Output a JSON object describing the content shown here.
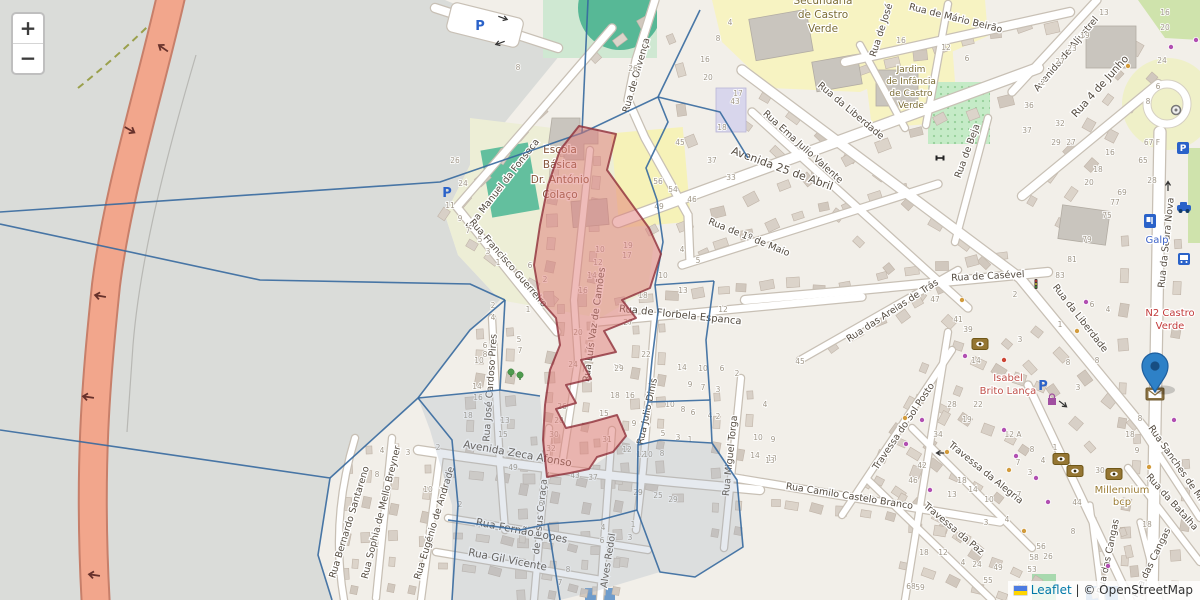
{
  "map": {
    "controls": {
      "zoom_in": "+",
      "zoom_out": "−"
    },
    "attribution": {
      "leaflet": "Leaflet",
      "separator": " | © ",
      "osm": "OpenStreetMap",
      "flag": "ukraine-flag"
    },
    "accent_colors": {
      "marker_blue": "#2E81C7",
      "overlay_red": "#E07A76",
      "overlay_red_border": "#8F2F3A",
      "boundary_blue": "#36699E",
      "trunk_road": "#F2A68C",
      "link_blue": "#0078A8"
    },
    "street_labels": [
      {
        "text": "Rua Manuel da Fonseca",
        "x": 505,
        "y": 186,
        "r": -52
      },
      {
        "text": "Rua Francisco Guerreiro",
        "x": 506,
        "y": 265,
        "r": 49
      },
      {
        "text": "Rua de Olivença",
        "x": 639,
        "y": 76,
        "r": -74
      },
      {
        "text": "Avenida 25 de Abril",
        "x": 781,
        "y": 172,
        "r": 20,
        "s": 11
      },
      {
        "text": "Rua da Liberdade",
        "x": 849,
        "y": 113,
        "r": 40
      },
      {
        "text": "Rua Ema Julio Valente",
        "x": 801,
        "y": 149,
        "r": 42
      },
      {
        "text": "Rua de Mário Beirão",
        "x": 955,
        "y": 21,
        "r": 14
      },
      {
        "text": "Rua de José",
        "x": 884,
        "y": 31,
        "r": -72
      },
      {
        "text": "Rua de Beja",
        "x": 970,
        "y": 152,
        "r": -70
      },
      {
        "text": "Avenida de Aljustrel",
        "x": 1038,
        "y": 92,
        "r": -50,
        "a": "start"
      },
      {
        "text": "Rua 4 de Junho",
        "x": 1076,
        "y": 118,
        "r": -48,
        "a": "start",
        "s": 10.5
      },
      {
        "text": "Rua da Seara Nova",
        "x": 1169,
        "y": 243,
        "r": -84
      },
      {
        "text": "Rua de Casével",
        "x": 988,
        "y": 279,
        "r": -3
      },
      {
        "text": "Rua da Liberdade",
        "x": 1078,
        "y": 320,
        "r": 52
      },
      {
        "text": "Rua de Florbela Espanca",
        "x": 680,
        "y": 318,
        "r": 6,
        "s": 10
      },
      {
        "text": "Rua de 1º de Maio",
        "x": 748,
        "y": 240,
        "r": 22
      },
      {
        "text": "Rua Luís Vaz de Camões",
        "x": 597,
        "y": 325,
        "r": -82
      },
      {
        "text": "Rua José Cardoso Pires",
        "x": 493,
        "y": 388,
        "r": -86
      },
      {
        "text": "Rua Julio Dinis",
        "x": 650,
        "y": 412,
        "r": -78
      },
      {
        "text": "Rua Miguel Torga",
        "x": 733,
        "y": 456,
        "r": -84
      },
      {
        "text": "Avenida Zeca Afonso",
        "x": 517,
        "y": 457,
        "r": 10,
        "s": 10.5
      },
      {
        "text": "Rua Fernão Lopes",
        "x": 521,
        "y": 534,
        "r": 11,
        "s": 10.5
      },
      {
        "text": "Rua Gil Vicente",
        "x": 507,
        "y": 563,
        "r": 11,
        "s": 10.5
      },
      {
        "text": "Rua Bernardo Santareno",
        "x": 352,
        "y": 523,
        "r": -73
      },
      {
        "text": "Rua Sophia de Mello Breyner",
        "x": 384,
        "y": 513,
        "r": -76
      },
      {
        "text": "Rua Eugénio de Andrade",
        "x": 437,
        "y": 524,
        "r": -73
      },
      {
        "text": "de Jesus Caraça",
        "x": 543,
        "y": 517,
        "r": -84
      },
      {
        "text": "Alves Redol",
        "x": 611,
        "y": 561,
        "r": -81
      },
      {
        "text": "Rua Camilo Castelo Branco",
        "x": 849,
        "y": 499,
        "r": 9
      },
      {
        "text": "Rua das Areias de Trás",
        "x": 894,
        "y": 313,
        "r": -33
      },
      {
        "text": "Travessa do Sol Posto",
        "x": 906,
        "y": 428,
        "r": -56
      },
      {
        "text": "Travessa da Alegria",
        "x": 984,
        "y": 475,
        "r": 39
      },
      {
        "text": "Travessa da Paz",
        "x": 952,
        "y": 531,
        "r": 40
      },
      {
        "text": "Rua Sanches de Miranda",
        "x": 1148,
        "y": 428,
        "r": 55,
        "a": "start"
      },
      {
        "text": "Rua da Batalha",
        "x": 1170,
        "y": 504,
        "r": 48
      },
      {
        "text": "Rua das Cangas",
        "x": 1111,
        "y": 557,
        "r": -78
      },
      {
        "text": "Rua das Cangas",
        "x": 1154,
        "y": 564,
        "r": -64
      }
    ],
    "poi_labels": [
      {
        "name": "school-basica-label",
        "lines": [
          "Escola",
          "Básica",
          "Dr. António",
          "Colaço"
        ],
        "x": 560,
        "y": 153,
        "lh": 15,
        "c": "#85553a",
        "s": 10.5
      },
      {
        "name": "school-secundaria-label",
        "lines": [
          "Secundária",
          "de Castro",
          "Verde"
        ],
        "x": 823,
        "y": 4,
        "lh": 14,
        "c": "#7b6c34",
        "s": 10.5
      },
      {
        "name": "kindergarten-label",
        "lines": [
          "Jardim",
          "de Infância",
          "de Castro",
          "Verde"
        ],
        "x": 911,
        "y": 72,
        "lh": 12,
        "c": "#7b6c34",
        "s": 9
      },
      {
        "name": "shop-isabel-label",
        "lines": [
          "Isabel",
          "Brito Lança"
        ],
        "x": 1008,
        "y": 381,
        "lh": 13,
        "c": "#c0504a",
        "s": 10
      },
      {
        "name": "n2-junction-label",
        "lines": [
          "N2 Castro",
          "Verde"
        ],
        "x": 1170,
        "y": 316,
        "lh": 13,
        "c": "#c23b3b",
        "s": 10
      },
      {
        "name": "galp-fuel-label",
        "lines": [
          "Galp"
        ],
        "x": 1157,
        "y": 243,
        "lh": 12,
        "c": "#3f64c8",
        "s": 10
      },
      {
        "name": "millennium-bank-label",
        "lines": [
          "Millennium",
          "bcp"
        ],
        "x": 1122,
        "y": 493,
        "lh": 12,
        "c": "#9b7c34",
        "s": 10
      }
    ],
    "icons": [
      {
        "name": "parking-icon",
        "x": 480,
        "y": 26
      },
      {
        "name": "parking-icon",
        "x": 447,
        "y": 193
      },
      {
        "name": "parking-icon",
        "x": 1043,
        "y": 386
      },
      {
        "name": "parking-box-icon",
        "x": 1183,
        "y": 148
      },
      {
        "name": "fuel-icon",
        "x": 1150,
        "y": 221
      },
      {
        "name": "bus-icon",
        "x": 1184,
        "y": 259
      },
      {
        "name": "car-icon",
        "x": 1184,
        "y": 208
      },
      {
        "name": "bank-icon",
        "x": 980,
        "y": 344
      },
      {
        "name": "bank-icon",
        "x": 1061,
        "y": 459
      },
      {
        "name": "bank-icon",
        "x": 1075,
        "y": 471
      },
      {
        "name": "bank-icon",
        "x": 1114,
        "y": 474
      },
      {
        "name": "post-envelope-icon",
        "x": 1155,
        "y": 394
      },
      {
        "name": "shopping-bag-icon",
        "x": 1052,
        "y": 400
      },
      {
        "name": "tree-icon",
        "x": 511,
        "y": 373
      },
      {
        "name": "tree-icon",
        "x": 520,
        "y": 376
      },
      {
        "name": "fitness-icon",
        "x": 940,
        "y": 158
      },
      {
        "name": "roundabout-monument-icon",
        "x": 1176,
        "y": 110
      },
      {
        "name": "traffic-signals-icon",
        "x": 1036,
        "y": 284
      }
    ],
    "poi_dots": {
      "purple": [
        [
          965,
          356
        ],
        [
          1004,
          430
        ],
        [
          1016,
          456
        ],
        [
          1036,
          478
        ],
        [
          1048,
          502
        ],
        [
          922,
          420
        ],
        [
          906,
          444
        ],
        [
          1086,
          302
        ],
        [
          1171,
          47
        ],
        [
          1196,
          40
        ],
        [
          1108,
          566
        ],
        [
          930,
          490
        ],
        [
          1174,
          420
        ]
      ],
      "orange": [
        [
          947,
          452
        ],
        [
          1009,
          470
        ],
        [
          1077,
          331
        ],
        [
          1149,
          467
        ],
        [
          1024,
          531
        ],
        [
          962,
          300
        ],
        [
          1128,
          66
        ],
        [
          905,
          418
        ]
      ],
      "red": [
        [
          1004,
          360
        ]
      ]
    },
    "house_numbers": [
      [
        "26",
        455,
        163
      ],
      [
        "24",
        463,
        186
      ],
      [
        "8",
        518,
        70
      ],
      [
        "11",
        450,
        208
      ],
      [
        "9",
        460,
        221
      ],
      [
        "7",
        468,
        233
      ],
      [
        "5",
        480,
        242
      ],
      [
        "3",
        488,
        254
      ],
      [
        "1",
        498,
        265
      ],
      [
        "6",
        530,
        268
      ],
      [
        "2",
        545,
        282
      ],
      [
        "2",
        493,
        308
      ],
      [
        "4",
        493,
        320
      ],
      [
        "1",
        528,
        312
      ],
      [
        "5",
        519,
        342
      ],
      [
        "7",
        520,
        353
      ],
      [
        "6",
        485,
        348
      ],
      [
        "8",
        485,
        357
      ],
      [
        "10",
        479,
        363
      ],
      [
        "14",
        477,
        389
      ],
      [
        "16",
        478,
        400
      ],
      [
        "18",
        468,
        418
      ],
      [
        "10",
        600,
        252
      ],
      [
        "12",
        598,
        265
      ],
      [
        "14",
        592,
        278
      ],
      [
        "16",
        583,
        293
      ],
      [
        "19",
        628,
        248
      ],
      [
        "17",
        627,
        258
      ],
      [
        "18",
        615,
        398
      ],
      [
        "15",
        604,
        416
      ],
      [
        "13",
        505,
        423
      ],
      [
        "15",
        503,
        437
      ],
      [
        "20",
        578,
        335
      ],
      [
        "24",
        573,
        367
      ],
      [
        "19",
        618,
        370
      ],
      [
        "27",
        628,
        325
      ],
      [
        "22",
        646,
        357
      ],
      [
        "29",
        619,
        371
      ],
      [
        "26",
        562,
        409
      ],
      [
        "28",
        559,
        423
      ],
      [
        "30",
        554,
        437
      ],
      [
        "32",
        551,
        451
      ],
      [
        "31",
        607,
        442
      ],
      [
        "9",
        634,
        426
      ],
      [
        "49",
        513,
        470
      ],
      [
        "16",
        630,
        398
      ],
      [
        "18",
        643,
        298
      ],
      [
        "4",
        682,
        252
      ],
      [
        "5",
        698,
        263
      ],
      [
        "10",
        663,
        278
      ],
      [
        "13",
        683,
        293
      ],
      [
        "12",
        723,
        312
      ],
      [
        "14",
        682,
        370
      ],
      [
        "10",
        703,
        371
      ],
      [
        "6",
        722,
        371
      ],
      [
        "2",
        737,
        376
      ],
      [
        "9",
        690,
        387
      ],
      [
        "7",
        703,
        390
      ],
      [
        "3",
        718,
        392
      ],
      [
        "10",
        670,
        407
      ],
      [
        "8",
        683,
        412
      ],
      [
        "6",
        693,
        415
      ],
      [
        "4",
        710,
        418
      ],
      [
        "2",
        718,
        419
      ],
      [
        "5",
        663,
        436
      ],
      [
        "3",
        678,
        440
      ],
      [
        "1",
        690,
        442
      ],
      [
        "12",
        641,
        457
      ],
      [
        "4",
        548,
        478
      ],
      [
        "6",
        541,
        506
      ],
      [
        "43",
        575,
        478
      ],
      [
        "37",
        593,
        480
      ],
      [
        "12",
        627,
        452
      ],
      [
        "10",
        648,
        457
      ],
      [
        "8",
        662,
        456
      ],
      [
        "29",
        638,
        495
      ],
      [
        "25",
        658,
        498
      ],
      [
        "29",
        673,
        502
      ],
      [
        "1",
        633,
        527
      ],
      [
        "3",
        630,
        540
      ],
      [
        "4",
        603,
        530
      ],
      [
        "6",
        602,
        543
      ],
      [
        "8",
        568,
        572
      ],
      [
        "7",
        560,
        585
      ],
      [
        "14",
        755,
        458
      ],
      [
        "13",
        772,
        461
      ],
      [
        "4",
        382,
        453
      ],
      [
        "3",
        408,
        455
      ],
      [
        "8",
        377,
        477
      ],
      [
        "2",
        438,
        450
      ],
      [
        "10",
        428,
        492
      ],
      [
        "2",
        460,
        507
      ],
      [
        "16",
        705,
        62
      ],
      [
        "20",
        708,
        80
      ],
      [
        "26",
        633,
        71
      ],
      [
        "4",
        730,
        25
      ],
      [
        "8",
        718,
        41
      ],
      [
        "17",
        738,
        96
      ],
      [
        "18",
        722,
        130
      ],
      [
        "45",
        680,
        145
      ],
      [
        "37",
        712,
        163
      ],
      [
        "56",
        658,
        184
      ],
      [
        "54",
        673,
        192
      ],
      [
        "46",
        692,
        202
      ],
      [
        "49",
        659,
        209
      ],
      [
        "43",
        735,
        104
      ],
      [
        "33",
        731,
        180
      ],
      [
        "16",
        901,
        43
      ],
      [
        "12",
        946,
        50
      ],
      [
        "6",
        967,
        61
      ],
      [
        "13",
        1104,
        15
      ],
      [
        "19",
        1085,
        38
      ],
      [
        "23",
        1072,
        51
      ],
      [
        "27",
        1060,
        64
      ],
      [
        "2",
        1043,
        85
      ],
      [
        "36",
        1029,
        108
      ],
      [
        "32",
        1060,
        126
      ],
      [
        "37",
        1027,
        133
      ],
      [
        "29",
        1056,
        145
      ],
      [
        "27",
        1071,
        145
      ],
      [
        "16",
        1110,
        155
      ],
      [
        "18",
        1098,
        172
      ],
      [
        "20",
        1089,
        185
      ],
      [
        "16",
        1165,
        15
      ],
      [
        "20",
        1165,
        30
      ],
      [
        "24",
        1162,
        63
      ],
      [
        "6",
        1158,
        89
      ],
      [
        "8",
        1148,
        104
      ],
      [
        "67 F",
        1152,
        145
      ],
      [
        "65",
        1143,
        163
      ],
      [
        "28",
        1152,
        183
      ],
      [
        "69",
        1122,
        195
      ],
      [
        "77",
        1115,
        205
      ],
      [
        "75",
        1107,
        218
      ],
      [
        "79",
        1087,
        242
      ],
      [
        "81",
        1072,
        262
      ],
      [
        "83",
        1060,
        278
      ],
      [
        "6",
        1092,
        307
      ],
      [
        "4",
        1108,
        312
      ],
      [
        "1",
        1060,
        327
      ],
      [
        "3",
        1020,
        342
      ],
      [
        "2",
        1015,
        297
      ],
      [
        "47",
        935,
        302
      ],
      [
        "41",
        958,
        322
      ],
      [
        "39",
        968,
        332
      ],
      [
        "45",
        800,
        364
      ],
      [
        "28",
        952,
        407
      ],
      [
        "34",
        938,
        437
      ],
      [
        "42",
        922,
        468
      ],
      [
        "46",
        913,
        483
      ],
      [
        "4",
        765,
        407
      ],
      [
        "10",
        758,
        440
      ],
      [
        "9",
        773,
        442
      ],
      [
        "13",
        770,
        463
      ],
      [
        "18",
        962,
        483
      ],
      [
        "8",
        1068,
        365
      ],
      [
        "8",
        1097,
        363
      ],
      [
        "3",
        1078,
        390
      ],
      [
        "22",
        978,
        407
      ],
      [
        "19",
        967,
        422
      ],
      [
        "12 A",
        1013,
        437
      ],
      [
        "14",
        976,
        363
      ],
      [
        "18",
        1130,
        437
      ],
      [
        "8",
        1140,
        421
      ],
      [
        "1",
        1055,
        450
      ],
      [
        "30",
        1100,
        473
      ],
      [
        "9",
        1137,
        453
      ],
      [
        "18",
        1147,
        527
      ],
      [
        "14",
        973,
        492
      ],
      [
        "13",
        952,
        497
      ],
      [
        "10",
        989,
        502
      ],
      [
        "7",
        1018,
        465
      ],
      [
        "3",
        1030,
        475
      ],
      [
        "8",
        1032,
        452
      ],
      [
        "4",
        1043,
        463
      ],
      [
        "7",
        1019,
        497
      ],
      [
        "4",
        1007,
        522
      ],
      [
        "3",
        986,
        525
      ],
      [
        "8",
        1073,
        534
      ],
      [
        "44",
        1077,
        505
      ],
      [
        "56",
        1041,
        549
      ],
      [
        "58",
        1034,
        560
      ],
      [
        "26",
        1048,
        559
      ],
      [
        "18",
        924,
        555
      ],
      [
        "12",
        943,
        555
      ],
      [
        "4",
        963,
        565
      ],
      [
        "24",
        977,
        567
      ],
      [
        "49",
        998,
        570
      ],
      [
        "55",
        988,
        583
      ],
      [
        "53",
        1032,
        572
      ],
      [
        "68",
        911,
        589
      ],
      [
        "59",
        920,
        590
      ],
      [
        "69",
        1022,
        589
      ]
    ]
  }
}
